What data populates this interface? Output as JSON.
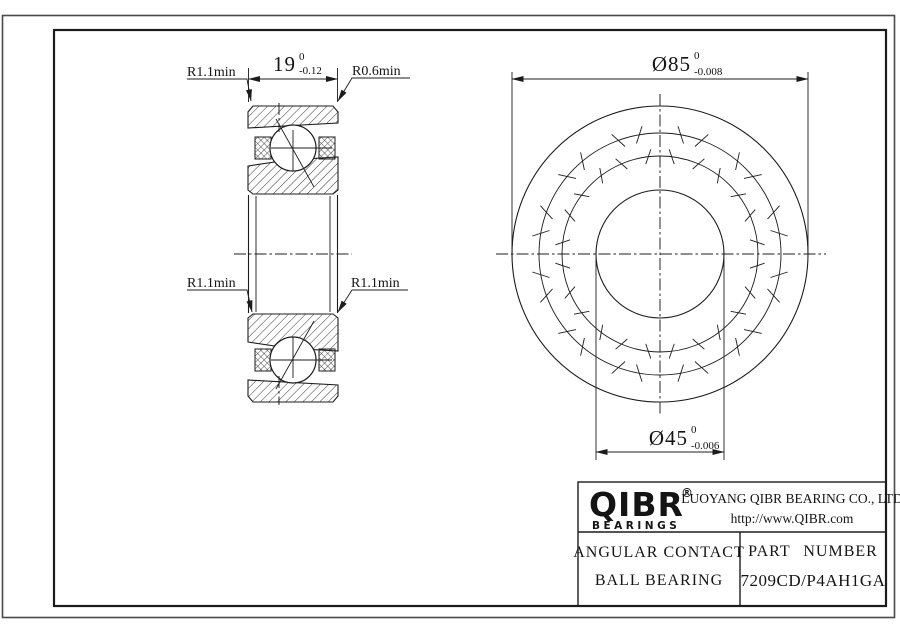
{
  "drawing": {
    "labels": {
      "r11_top_left": "R1.1min",
      "r06_top_right": "R0.6min",
      "r11_mid_left": "R1.1min",
      "r11_mid_right": "R1.1min"
    },
    "dims": {
      "width": {
        "value": "19",
        "tol_upper": "0",
        "tol_lower": "-0.12"
      },
      "od": {
        "value": "Ø85",
        "tol_upper": "0",
        "tol_lower": "-0.008"
      },
      "bore": {
        "value": "Ø45",
        "tol_upper": "0",
        "tol_lower": "-0.006"
      }
    }
  },
  "title_block": {
    "logo": {
      "name": "QIBR",
      "registered": "®",
      "sub": "BEARINGS"
    },
    "company": "LUOYANG QIBR BEARING CO., LTD",
    "website": "http://www.QIBR.com",
    "product_line1": "ANGULAR CONTACT",
    "product_line2": "BALL BEARING",
    "part_number_label": "PART NUMBER",
    "part_number": "7209CD/P4AH1GA"
  },
  "colors": {
    "line": "#1c1c1c",
    "sheet_border": "#4a4a4a",
    "background": "#ffffff"
  }
}
